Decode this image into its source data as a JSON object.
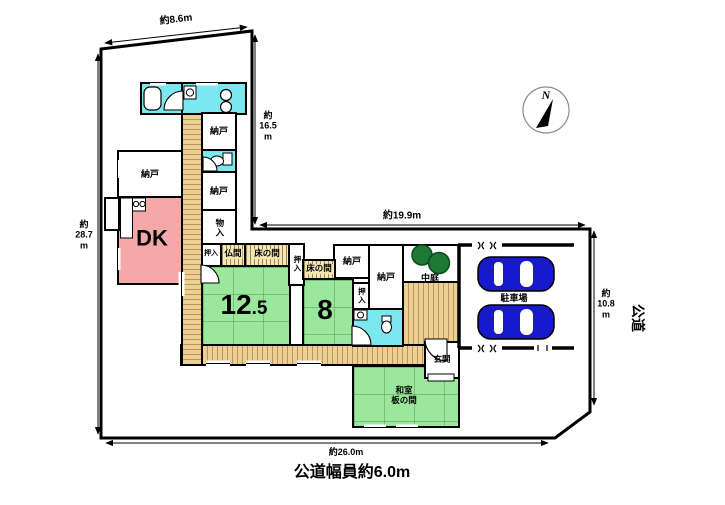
{
  "plan": {
    "compass": {
      "north": "N"
    },
    "dims": {
      "top": "約8.6m",
      "upper_right": [
        "約",
        "16.5",
        "m"
      ],
      "middle": "約19.9m",
      "left": [
        "約",
        "28.7",
        "m"
      ],
      "right": [
        "約",
        "10.8",
        "m"
      ],
      "bottom": "約26.0m"
    },
    "road": {
      "name": "公道",
      "width_note": "公道幅員約6.0m"
    },
    "rooms": {
      "dk": "DK",
      "nando_top": "納戸",
      "nando_mid": "納戸",
      "nando_left": "納戸",
      "nando_right_small": "納戸",
      "nando_right_large": "納戸",
      "monoire": "物入",
      "oshiire_top": "押入",
      "oshiire_east": "押入",
      "oshiire_right": "押入",
      "butsuma": "仏間",
      "tokonoma_west": "床の間",
      "tokonoma_east": "床の間",
      "tatami_125_int": "12",
      "tatami_125_frac": ".5",
      "tatami_8": "8",
      "courtyard": "中庭",
      "entrance": "玄関",
      "washitsu_line1": "和室",
      "washitsu_line2": "板の間",
      "parking": "駐車場"
    },
    "colors": {
      "tatami": "#9be79b",
      "dk_pink": "#f5a8a8",
      "wet_cyan": "#7de7f0",
      "wood": "#ebcf94",
      "alcove": "#f4e6b4",
      "tree": "#1c7a33",
      "car": "#1818cc",
      "wall": "#000000"
    }
  }
}
